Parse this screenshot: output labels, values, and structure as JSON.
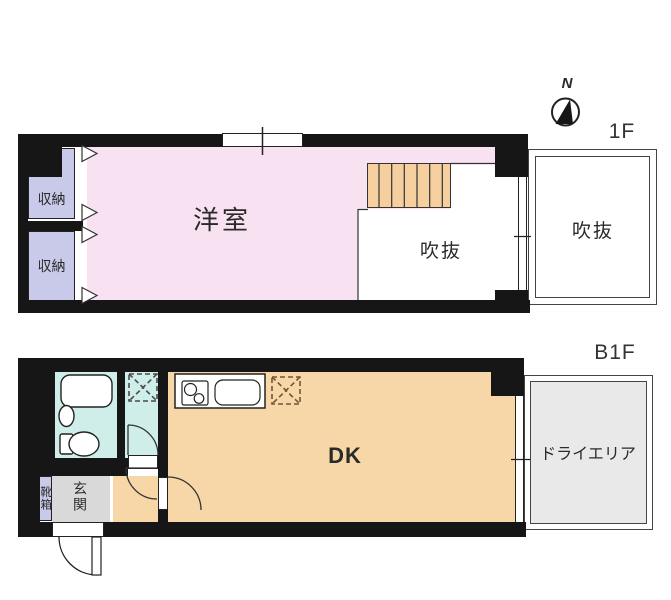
{
  "page": {
    "background": "#ffffff"
  },
  "palette": {
    "wall": "#161616",
    "western_room_pink": "#f8e1f1",
    "storage_lavender": "#c9c9e9",
    "dk_orange": "#f7d7a8",
    "stairs_orange": "#f5cf9e",
    "bath_cyan": "#cfeeea",
    "entrance_gray": "#d9d9d9",
    "dry_area_gray": "#e9e9e9"
  },
  "floor_1f": {
    "floor_label": "1F",
    "compass_north_label": "N",
    "western_room_label": "洋室",
    "storage_top_label": "収納",
    "storage_bottom_label": "収納",
    "void_inner_label": "吹抜",
    "void_outer_label": "吹抜"
  },
  "floor_b1f": {
    "floor_label": "B1F",
    "dk_label": "DK",
    "entrance_label": "玄関",
    "shoe_box_label": "靴箱",
    "dry_area_label": "ドライエリア"
  }
}
